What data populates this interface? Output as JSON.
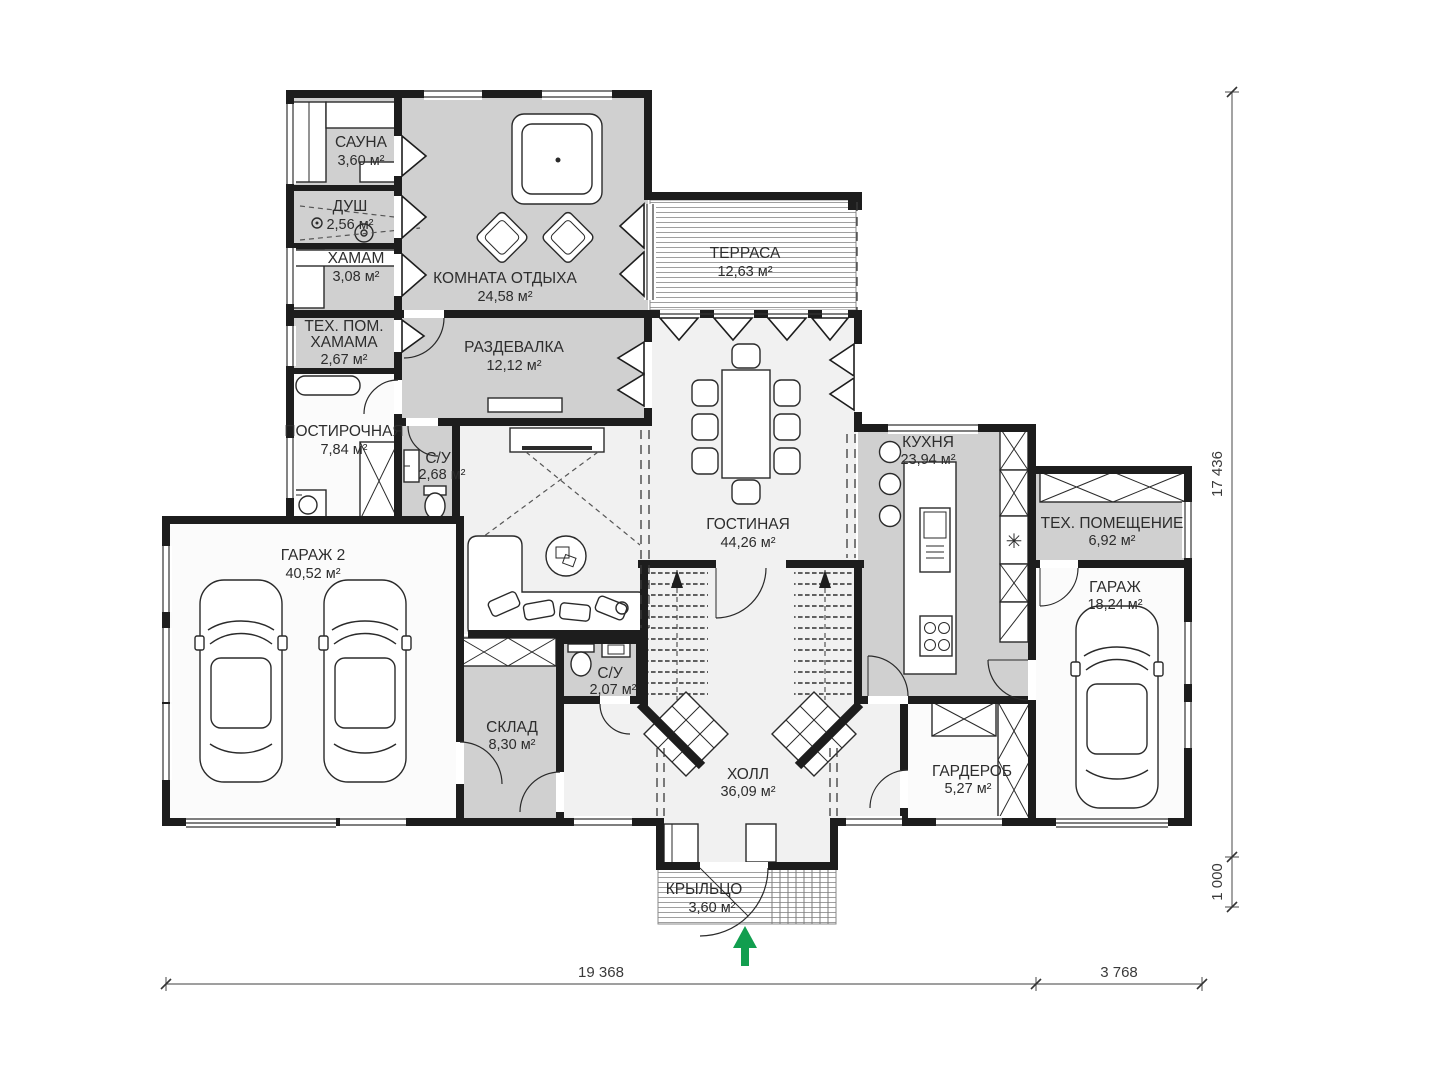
{
  "type": "architectural-floor-plan",
  "rooms": [
    {
      "id": "sauna",
      "lines": [
        "САУНА",
        "3,60 м²"
      ]
    },
    {
      "id": "shower",
      "lines": [
        "ДУШ",
        "2,56 м²"
      ]
    },
    {
      "id": "hammam",
      "lines": [
        "ХАМАМ",
        "3,08 м²"
      ]
    },
    {
      "id": "hammam-tech",
      "lines": [
        "ТЕХ. ПОМ.",
        "ХАМАМА",
        "2,67 м²"
      ]
    },
    {
      "id": "laundry",
      "lines": [
        "ПОСТИРОЧНАЯ",
        "7,84 м²"
      ]
    },
    {
      "id": "lounge",
      "lines": [
        "КОМНАТА ОТДЫХА",
        "24,58 м²"
      ]
    },
    {
      "id": "dressing",
      "lines": [
        "РАЗДЕВАЛКА",
        "12,12 м²"
      ]
    },
    {
      "id": "terrace",
      "lines": [
        "ТЕРРАСА",
        "12,63 м²"
      ]
    },
    {
      "id": "living-room",
      "lines": [
        "ГОСТИНАЯ",
        "44,26 м²"
      ]
    },
    {
      "id": "kitchen",
      "lines": [
        "КУХНЯ",
        "23,94 м²"
      ]
    },
    {
      "id": "tech-room",
      "lines": [
        "ТЕХ. ПОМЕЩЕНИЕ",
        "6,92 м²"
      ]
    },
    {
      "id": "garage",
      "lines": [
        "ГАРАЖ",
        "18,24 м²"
      ]
    },
    {
      "id": "garage-2",
      "lines": [
        "ГАРАЖ 2",
        "40,52 м²"
      ]
    },
    {
      "id": "wc-1",
      "lines": [
        "С/У",
        "2,68 м²"
      ]
    },
    {
      "id": "wc-2",
      "lines": [
        "С/У",
        "2,07 м²"
      ]
    },
    {
      "id": "storage",
      "lines": [
        "СКЛАД",
        "8,30 м²"
      ]
    },
    {
      "id": "hall",
      "lines": [
        "ХОЛЛ",
        "36,09 м²"
      ]
    },
    {
      "id": "wardrobe",
      "lines": [
        "ГАРДЕРОБ",
        "5,27 м²"
      ]
    },
    {
      "id": "porch",
      "lines": [
        "КРЫЛЬЦО",
        "3,60 м²"
      ]
    }
  ],
  "dimensions": {
    "right_main": "17 436",
    "right_small": "1 000",
    "bottom_left": "19 368",
    "bottom_right": "3 768"
  },
  "colors": {
    "wall": "#1d1d1d",
    "room_fill_gray": "#d0d0d0",
    "room_fill_light": "#f1f1f1",
    "room_fill_white": "#fbfbfb",
    "hatch_line": "#9f9f9f",
    "entrance_arrow_green": "#129e4f",
    "dimension_text": "#3a3a3a",
    "label_text": "#2d2d2d"
  }
}
